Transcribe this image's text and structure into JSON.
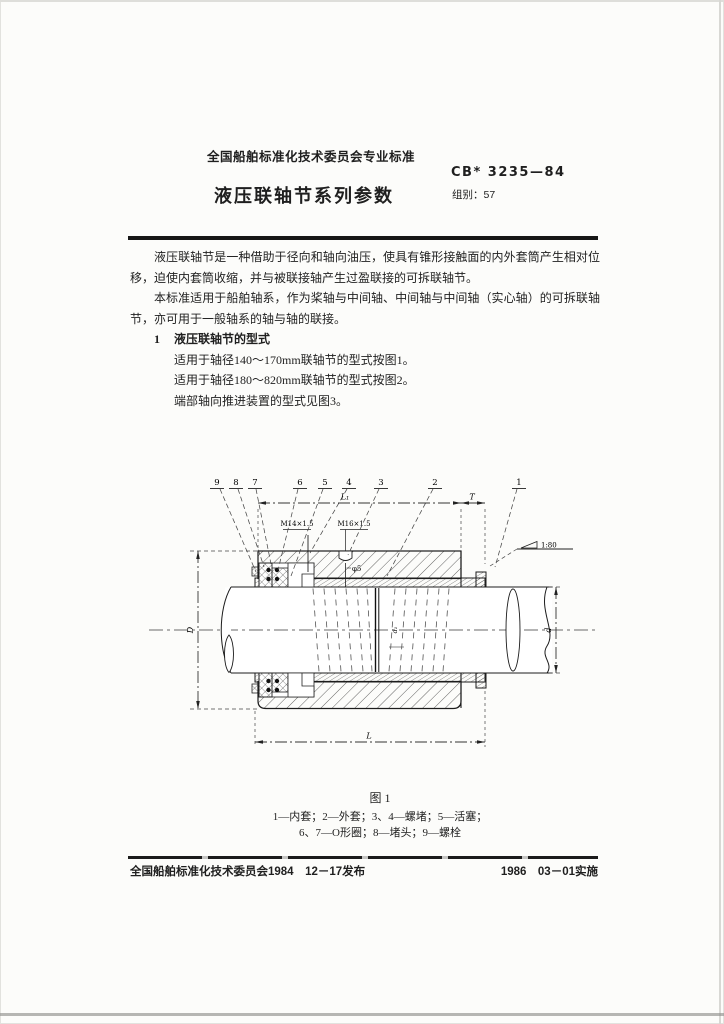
{
  "page": {
    "header_org": "全国船舶标准化技术委员会专业标准",
    "doc_number": "CB* 3235—84",
    "group_label": "组别：57",
    "title": "液压联轴节系列参数"
  },
  "body": {
    "para1": "液压联轴节是一种借助于径向和轴向油压，使具有锥形接触面的内外套筒产生相对位移，迫使内套筒收缩，并与被联接轴产生过盈联接的可拆联轴节。",
    "para2": "本标准适用于船舶轴系，作为桨轴与中间轴、中间轴与中间轴（实心轴）的可拆联轴节，亦可用于一般轴系的轴与轴的联接。",
    "section1_no": "1",
    "section1_title": "液压联轴节的型式",
    "line1": "适用于轴径140～170mm联轴节的型式按图1。",
    "line2": "适用于轴径180～820mm联轴节的型式按图2。",
    "line3": "端部轴向推进装置的型式见图3。"
  },
  "figure": {
    "caption": "图 1",
    "legend_line1": "1—内套；2—外套；3、4—螺堵；5—活塞；",
    "legend_line2": "6、7—O形圈；8—堵头；9—螺栓",
    "callouts": [
      "9",
      "8",
      "7",
      "6",
      "5",
      "4",
      "3",
      "2",
      "1"
    ],
    "labels": {
      "m14": "M14×1.5",
      "m16": "M16×1.5",
      "phi5": "φ5",
      "taper": "1:80",
      "dim_L1": "L₁",
      "dim_T": "T",
      "dim_D": "D",
      "dim_d": "d",
      "dim_L": "L",
      "dim_d1": "d₁"
    }
  },
  "footer": {
    "left": "全国船舶标准化技术委员会1984　12－17发布",
    "right": "1986　03－01实施"
  }
}
